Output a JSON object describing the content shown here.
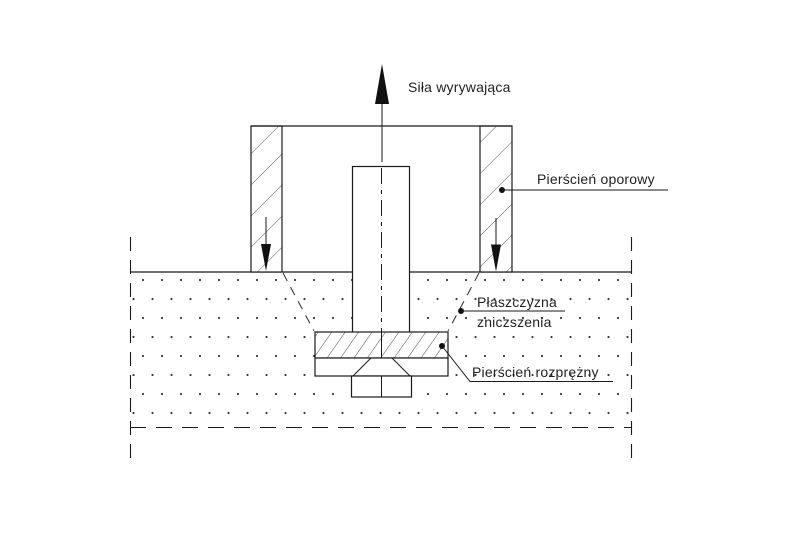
{
  "diagram": {
    "labels": {
      "force": "Siła wyrywająca",
      "support_ring": "Pierścień oporowy",
      "failure_plane_line1": "Płaszczyzna",
      "failure_plane_line2": "zniczszenia",
      "expansion_ring": "Pierścień rozprężny"
    },
    "colors": {
      "line": "#1a1a1a",
      "hatch": "#5a5a5a",
      "background": "#ffffff"
    }
  }
}
